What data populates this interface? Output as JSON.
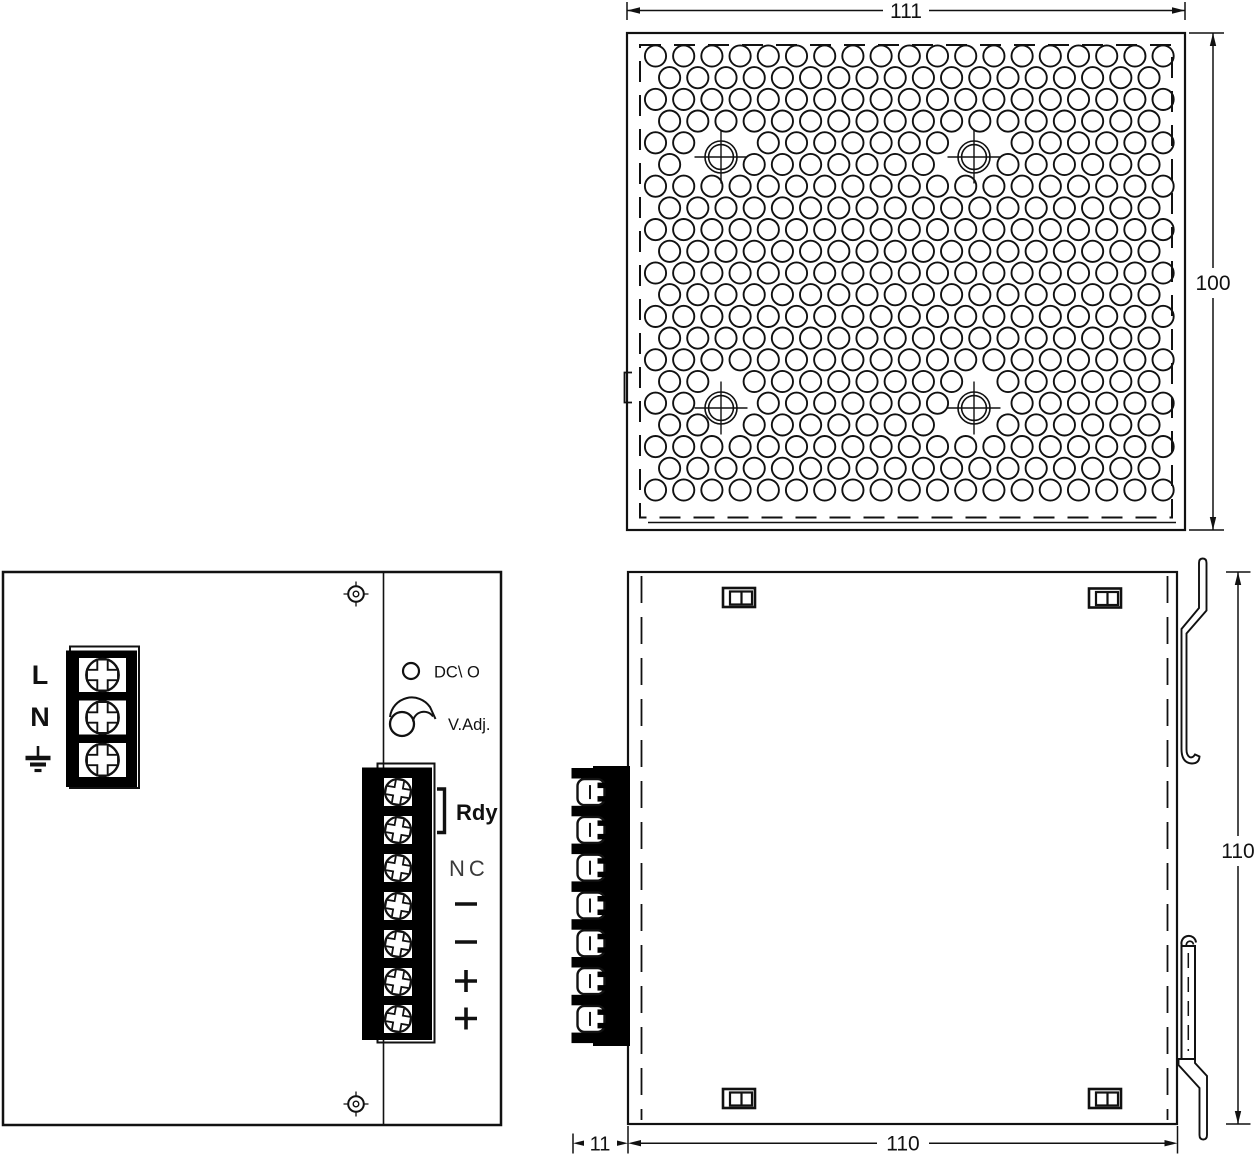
{
  "title": "power-supply-mechanical-drawing",
  "top_view": {
    "width_dim": "111",
    "height_dim": "100"
  },
  "front_view": {
    "input_terminals": [
      "L",
      "N"
    ],
    "ground": "chassis-ground",
    "indicators": {
      "led": "DC\\ O",
      "adjust": "V.Adj."
    },
    "output_terminals": {
      "relay": "Rdy",
      "nc": "NC",
      "polarity": [
        "−",
        "−",
        "+",
        "+"
      ]
    }
  },
  "side_view": {
    "depth_dim": "11",
    "width_dim": "110",
    "height_dim": "110"
  }
}
